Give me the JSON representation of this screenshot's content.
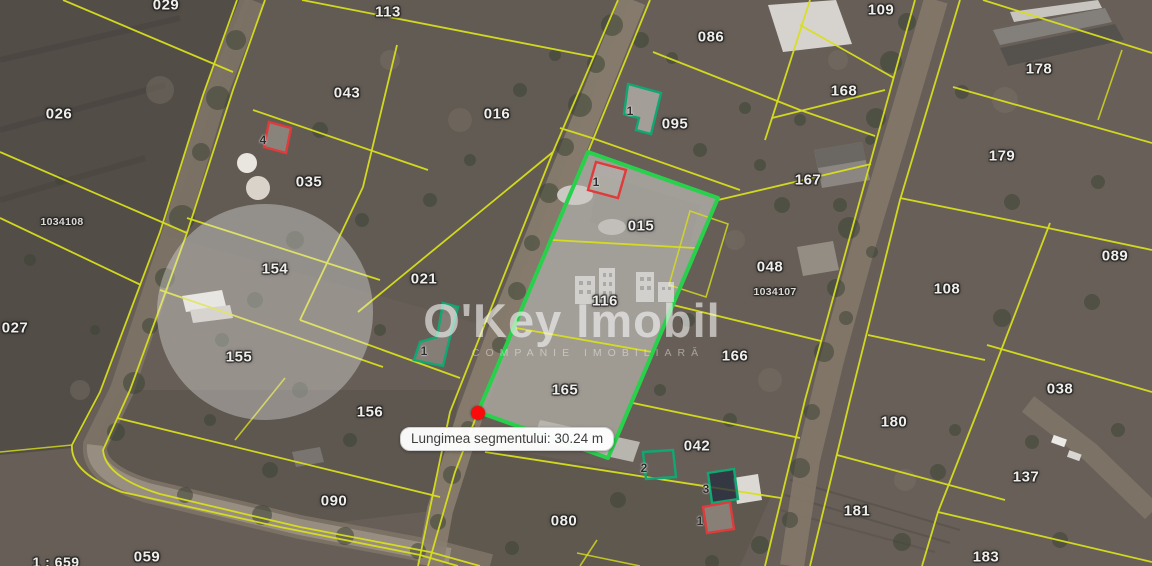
{
  "map": {
    "watermark": {
      "title": "O'Key Imobil",
      "subtitle": "COMPANIE IMOBILIARĂ"
    },
    "measurement_tooltip": {
      "label": "Lungimea segmentului: 30.24 m"
    },
    "scale_label": "1 : 659",
    "colors": {
      "parcel_line": "#d8de1c",
      "selected_parcel_outline": "#29d04b",
      "building_ok_outline": "#0fa873",
      "building_bad_outline": "#e03a3a",
      "marker": "#fa0a0a"
    },
    "selected_parcel": {
      "ids": [
        "015",
        "116",
        "165"
      ],
      "outline_color": "#29d04b"
    },
    "marker": {
      "x": 478,
      "y": 413,
      "color": "#fa0a0a"
    },
    "parcel_labels": [
      {
        "id": "029",
        "x": 166,
        "y": 5
      },
      {
        "id": "113",
        "x": 388,
        "y": 12
      },
      {
        "id": "086",
        "x": 711,
        "y": 37
      },
      {
        "id": "109",
        "x": 881,
        "y": 10
      },
      {
        "id": "178",
        "x": 1039,
        "y": 69
      },
      {
        "id": "026",
        "x": 59,
        "y": 114
      },
      {
        "id": "043",
        "x": 347,
        "y": 93
      },
      {
        "id": "016",
        "x": 497,
        "y": 114
      },
      {
        "id": "095",
        "x": 675,
        "y": 124
      },
      {
        "id": "168",
        "x": 844,
        "y": 91
      },
      {
        "id": "179",
        "x": 1002,
        "y": 156
      },
      {
        "id": "035",
        "x": 309,
        "y": 182
      },
      {
        "id": "167",
        "x": 808,
        "y": 180
      },
      {
        "id": "1034108",
        "x": 62,
        "y": 222,
        "small": true
      },
      {
        "id": "015",
        "x": 641,
        "y": 226
      },
      {
        "id": "048",
        "x": 770,
        "y": 267
      },
      {
        "id": "089",
        "x": 1115,
        "y": 256
      },
      {
        "id": "154",
        "x": 275,
        "y": 269
      },
      {
        "id": "021",
        "x": 424,
        "y": 279
      },
      {
        "id": "116",
        "x": 605,
        "y": 301
      },
      {
        "id": "1034107",
        "x": 775,
        "y": 292,
        "small": true
      },
      {
        "id": "108",
        "x": 947,
        "y": 289
      },
      {
        "id": "027",
        "x": 15,
        "y": 328
      },
      {
        "id": "155",
        "x": 239,
        "y": 357
      },
      {
        "id": "166",
        "x": 735,
        "y": 356
      },
      {
        "id": "038",
        "x": 1060,
        "y": 389
      },
      {
        "id": "165",
        "x": 565,
        "y": 390
      },
      {
        "id": "156",
        "x": 370,
        "y": 412
      },
      {
        "id": "180",
        "x": 894,
        "y": 422
      },
      {
        "id": "042",
        "x": 697,
        "y": 446
      },
      {
        "id": "137",
        "x": 1026,
        "y": 477
      },
      {
        "id": "090",
        "x": 334,
        "y": 501
      },
      {
        "id": "181",
        "x": 857,
        "y": 511
      },
      {
        "id": "080",
        "x": 564,
        "y": 521
      },
      {
        "id": "059",
        "x": 147,
        "y": 557
      },
      {
        "id": "183",
        "x": 986,
        "y": 557
      }
    ],
    "building_labels": [
      {
        "text": "4",
        "x": 263,
        "y": 140
      },
      {
        "text": "1",
        "x": 630,
        "y": 111
      },
      {
        "text": "1",
        "x": 596,
        "y": 182
      },
      {
        "text": "1",
        "x": 424,
        "y": 351
      },
      {
        "text": "2",
        "x": 644,
        "y": 468
      },
      {
        "text": "3",
        "x": 706,
        "y": 489
      },
      {
        "text": "1",
        "x": 700,
        "y": 521
      }
    ]
  }
}
